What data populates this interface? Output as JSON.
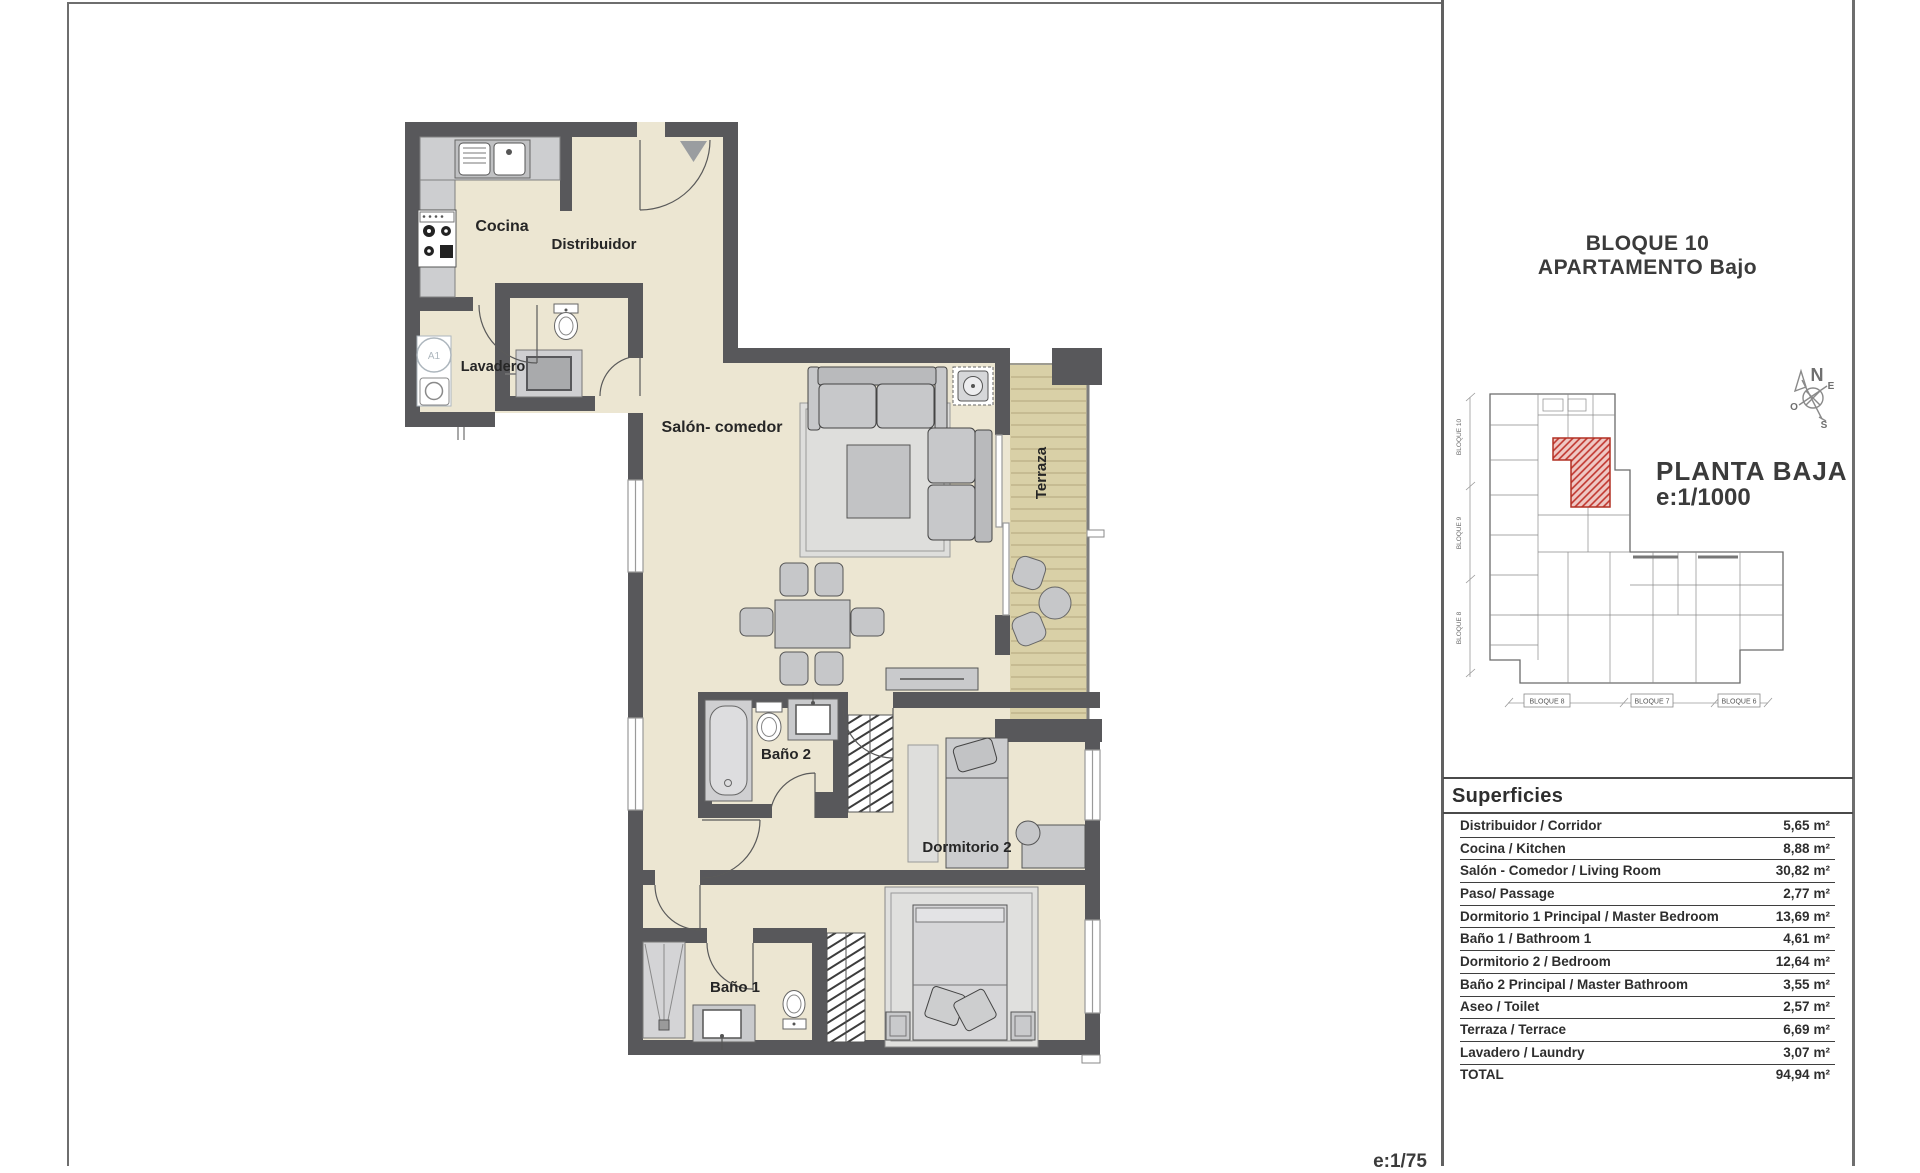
{
  "page": {
    "title_line1": "BLOQUE 10",
    "title_line2": "APARTAMENTO Bajo",
    "scale_note": "e:1/75"
  },
  "floorplan": {
    "rooms": {
      "cocina": "Cocina",
      "distribuidor": "Distribuidor",
      "lavadero": "Lavadero",
      "salon": "Salón- comedor",
      "terraza": "Terraza",
      "bano2": "Baño 2",
      "dormitorio2": "Dormitorio 2",
      "bano1": "Baño 1"
    },
    "washer_label": "A1",
    "colors": {
      "wall": "#58585B",
      "floor": "#ECE6D2",
      "terrace_floor": "#D9D0A7",
      "furniture": "#C7C8CA"
    }
  },
  "site_plan": {
    "caption_line1": "PLANTA BAJA",
    "caption_line2": "e:1/1000",
    "compass": {
      "n": "N",
      "e": "E",
      "s": "S",
      "o": "O"
    },
    "block_labels_left": [
      "BLOQUE 10",
      "BLOQUE 9",
      "BLOQUE 8"
    ],
    "block_labels_bottom": [
      "BLOQUE 8",
      "BLOQUE 7",
      "BLOQUE 6"
    ],
    "highlight_color": "#C0332B"
  },
  "areas_table": {
    "header": "Superficies",
    "unit": "m²",
    "rows": [
      {
        "label": "Distribuidor / Corridor",
        "value": "5,65"
      },
      {
        "label": "Cocina / Kitchen",
        "value": "8,88"
      },
      {
        "label": "Salón - Comedor / Living Room",
        "value": "30,82"
      },
      {
        "label": "Paso/ Passage",
        "value": "2,77"
      },
      {
        "label": "Dormitorio 1 Principal / Master Bedroom",
        "value": "13,69"
      },
      {
        "label": "Baño 1 / Bathroom 1",
        "value": "4,61"
      },
      {
        "label": "Dormitorio 2 / Bedroom",
        "value": "12,64"
      },
      {
        "label": "Baño 2 Principal / Master Bathroom",
        "value": "3,55"
      },
      {
        "label": "Aseo / Toilet",
        "value": "2,57"
      },
      {
        "label": "Terraza / Terrace",
        "value": "6,69"
      },
      {
        "label": "Lavadero / Laundry",
        "value": "3,07"
      },
      {
        "label": "TOTAL",
        "value": "94,94"
      }
    ]
  }
}
